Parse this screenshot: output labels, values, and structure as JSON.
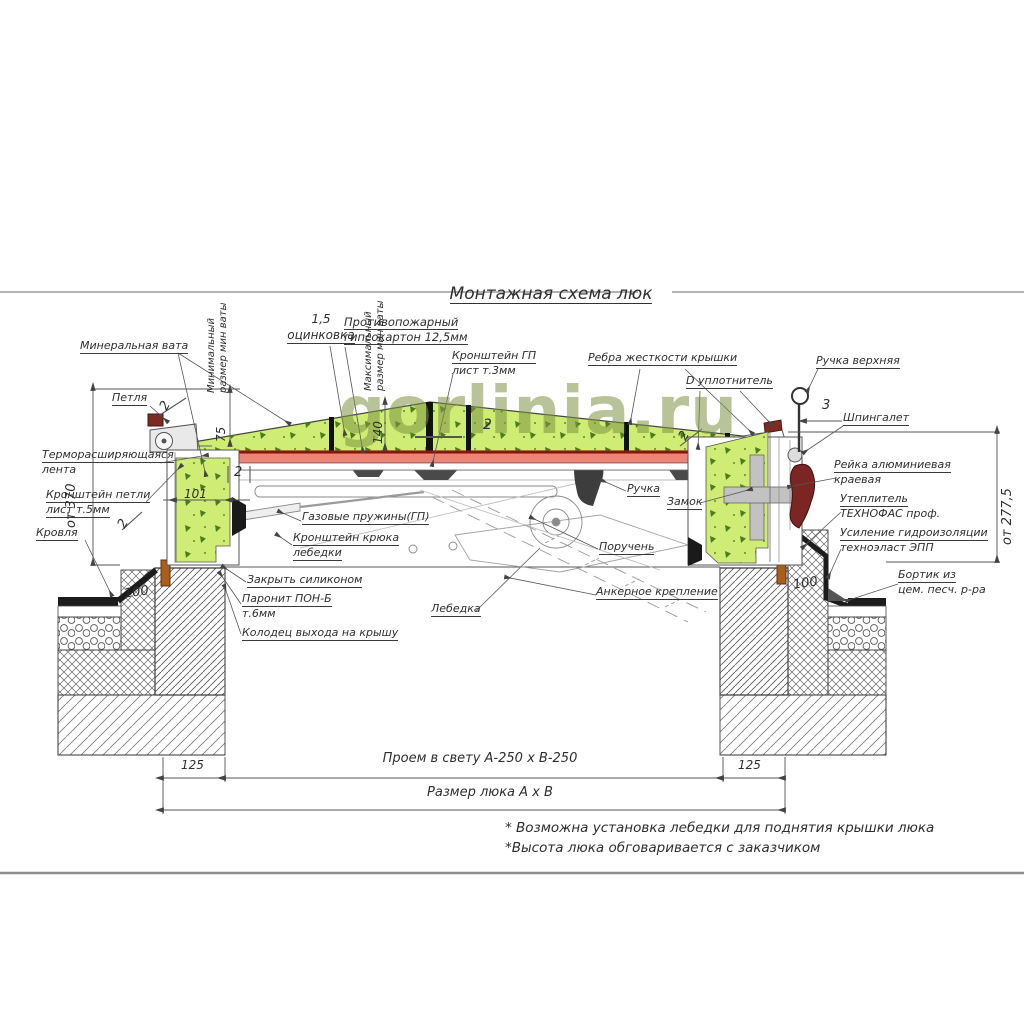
{
  "title": "Монтажная схема люк",
  "watermark": "gorlinia.ru",
  "labels": {
    "mineral_wool": "Минеральная вата",
    "min_wool_size": [
      "Минимальный",
      "размер мин ваты"
    ],
    "max_wool_size": [
      "Максимальный",
      "размер мин ваты"
    ],
    "zinc": [
      "1,5",
      "оцинковка"
    ],
    "fire_gypsum": [
      "Противопожарный",
      "гипсокартон 12,5мм"
    ],
    "gp_bracket": [
      "Кронштейн ГП",
      "лист т.3мм"
    ],
    "cover_ribs": "Ребра жесткости крышки",
    "d_seal": "D уплотнитель",
    "top_handle": "Ручка верхняя",
    "latch": "Шпингалет",
    "edge_rail": [
      "Рейка алюминиевая",
      "краевая"
    ],
    "insulation": [
      "Утеплитель",
      "ТЕХНОФАС проф."
    ],
    "waterproofing": [
      "Усиление гидроизоляции",
      "техноэласт ЭПП"
    ],
    "cement_curb": [
      "Бортик из",
      "цем. песч. р-ра"
    ],
    "hinge": "Петля",
    "thermo_tape": [
      "Терморасширяющаяся",
      "лента"
    ],
    "hinge_bracket": [
      "Кронштейн петли",
      "лист т.5мм"
    ],
    "roof": "Кровля",
    "silicone": "Закрыть силиконом",
    "paronit": [
      "Паронит ПОН-Б",
      "т.6мм"
    ],
    "roof_well": "Колодец выхода на крышу",
    "gas_springs": "Газовые пружины(ГП)",
    "hook_bracket": [
      "Кронштейн крюка",
      "лебедки"
    ],
    "winch": "Лебедка",
    "handle": "Ручка",
    "lock": "Замок",
    "handrail": "Поручень",
    "anchor": "Анкерное крепление"
  },
  "dimensions": {
    "left_height": "от 370",
    "right_height": "от 277,5",
    "min_wool": "75",
    "max_wool": "140",
    "curb_width": "101",
    "wall_left": "100",
    "wall_right": "100",
    "offset_left": "125",
    "offset_right": "125",
    "thickness_2": "2",
    "thickness_3": "3",
    "opening": "Проем в свету А-250 х В-250",
    "hatch_size": "Размер люка А х В"
  },
  "notes": [
    "* Возможна установка лебедки для поднятия крышки люка",
    "*Высота люка обговаривается с заказчиком"
  ]
}
